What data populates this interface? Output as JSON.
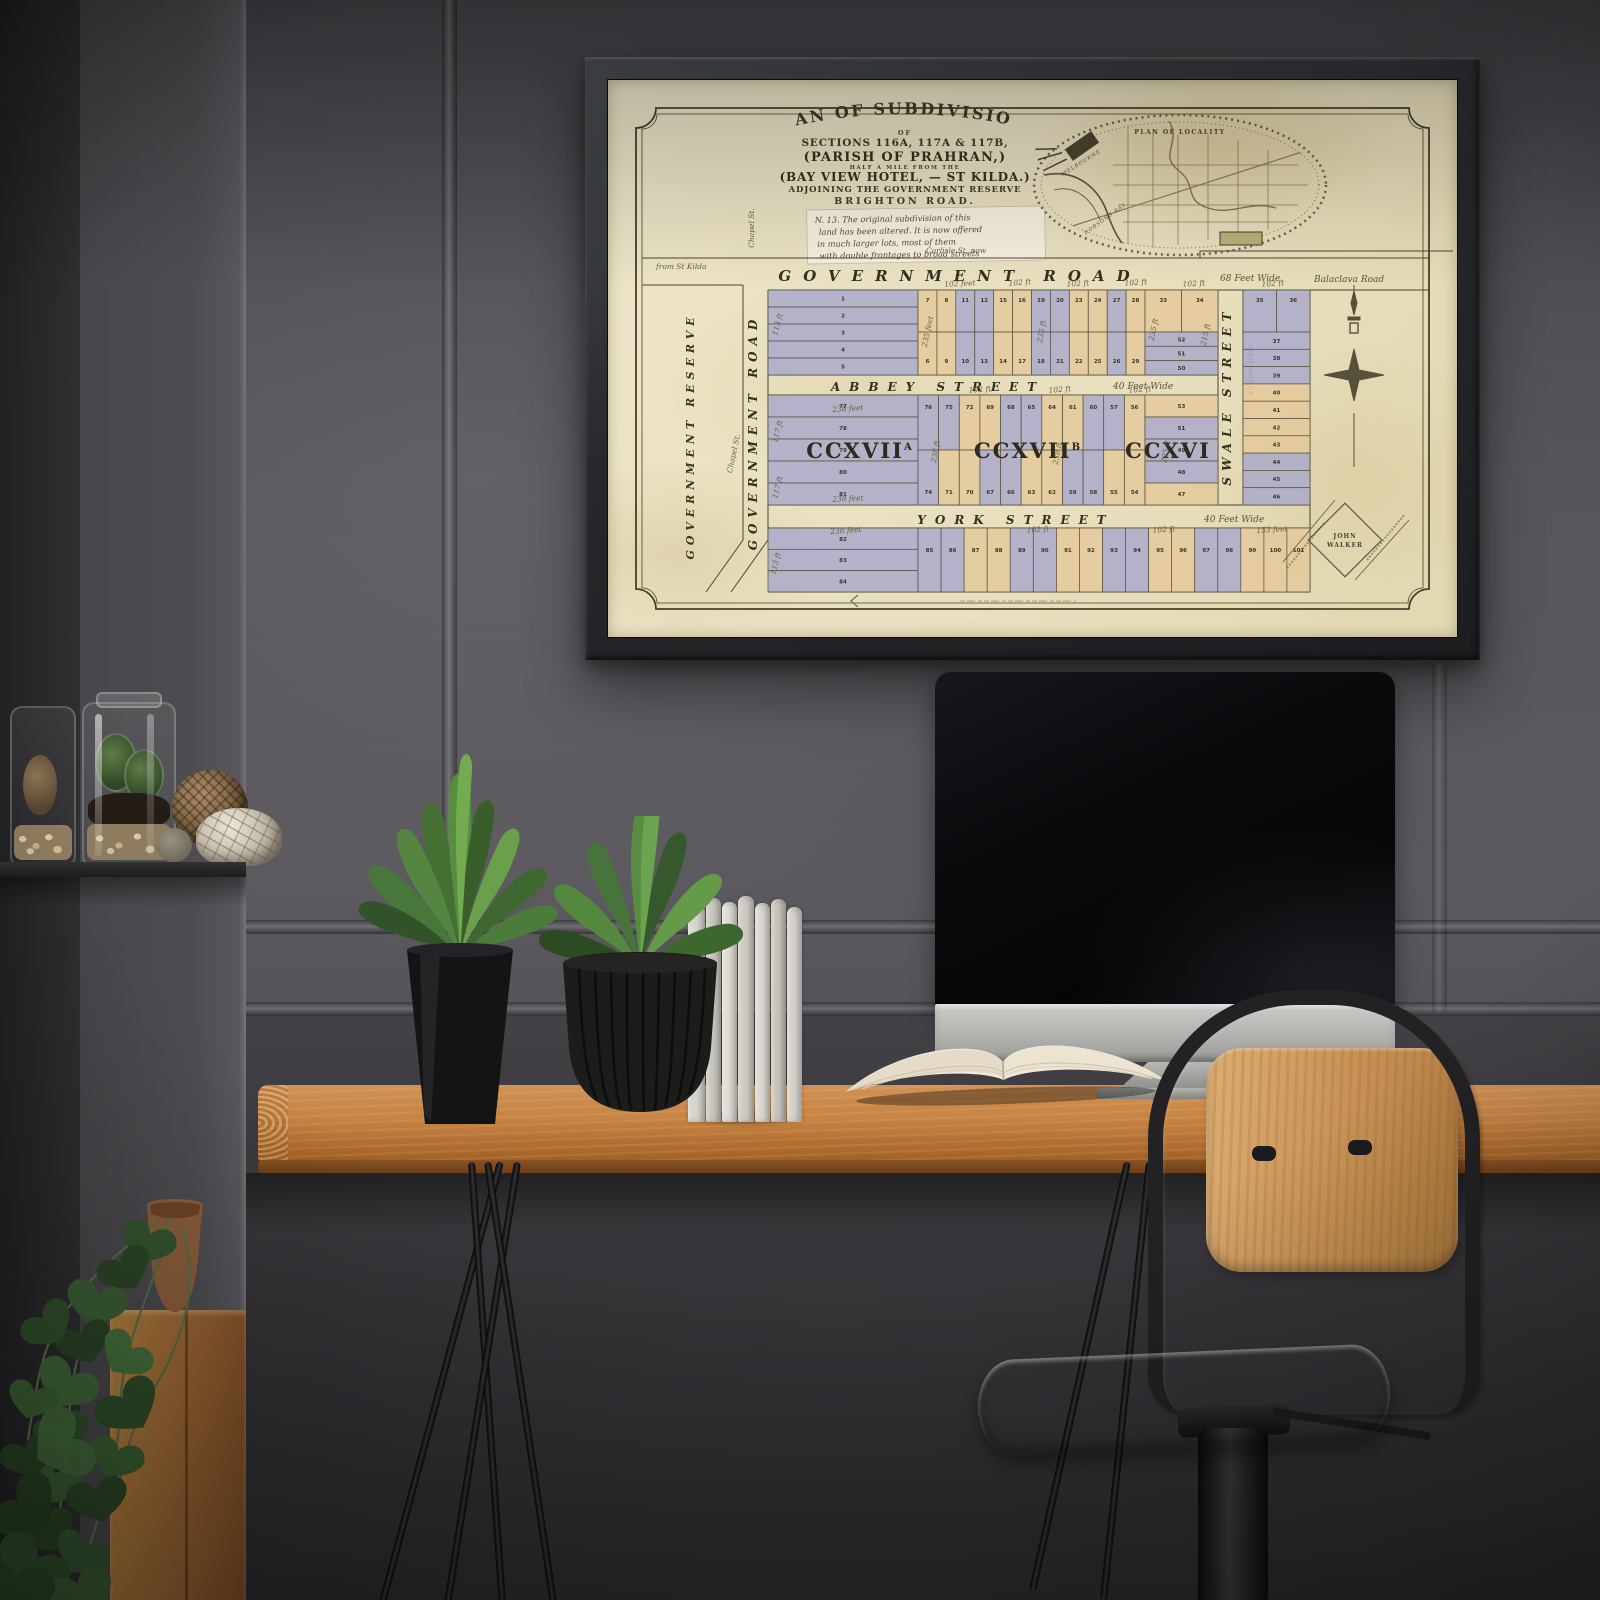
{
  "scene": {
    "palette": {
      "wall": "#57555a",
      "wall_left": "#47464a",
      "desk_wood": "#c08343",
      "frame": "#2e3033",
      "monitor_silver": "#b7b7b3",
      "chair_wood": "#c99356",
      "plant_green": "#568c3f"
    }
  },
  "map": {
    "palette": {
      "paper": "#eae3c2",
      "ink": "#3f3b28",
      "script": "#6b6040",
      "lot_blue": "#a8a8ca",
      "lot_tan": "#e4c89b",
      "lot_cream": "#e7e0bf"
    },
    "title": {
      "line1": "PLAN OF SUBDIVISIONS",
      "line2": "OF",
      "line3": "SECTIONS 116A, 117A & 117B,",
      "line4": "(PARISH OF PRAHRAN,)",
      "line5": "HALF A MILE FROM THE",
      "line6": "(BAY VIEW HOTEL, — ST KILDA.)",
      "line7": "ADJOINING THE GOVERNMENT RESERVE",
      "line8": "BRIGHTON ROAD."
    },
    "note_lines": [
      "N. 13. The original subdivision of this",
      "land has been altered.  It is now offered",
      "in much larger lots, most of them",
      "with double frontages to broad streets"
    ],
    "locality": {
      "title": "PLAN OF LOCALITY",
      "bay": "HOBSONS BAY",
      "city": "MELBOURNE"
    },
    "roads": {
      "government": "GOVERNMENT ROAD",
      "government_width": "68 Feet Wide",
      "balaclava": "Balaclava Road",
      "carlisle": "Carlisle St. now",
      "from_st_kilda": "from St Kilda",
      "chapel": "Chapel St.",
      "reserve": "GOVERNMENT RESERVE",
      "government_v": "GOVERNMENT ROAD",
      "abbey": "ABBEY STREET",
      "abbey_width": "40 Feet Wide",
      "york": "YORK STREET",
      "york_width": "40 Feet Wide",
      "swale": "SWALE STREET",
      "swale_width": "40 Feet Wide"
    },
    "sections": [
      {
        "name": "CCXVII",
        "sup": "A",
        "x": 252,
        "y": 378
      },
      {
        "name": "CCXVII",
        "sup": "B",
        "x": 420,
        "y": 378
      },
      {
        "name": "CCXVI",
        "sup": "",
        "x": 560,
        "y": 378
      }
    ],
    "stamp": {
      "line1": "JOHN",
      "line2": "WALKER"
    },
    "blocks": {
      "a_left": {
        "lots": [
          "1",
          "2",
          "3",
          "4",
          "5"
        ],
        "colors": [
          "b",
          "b",
          "b",
          "b",
          "b"
        ]
      },
      "a_top": {
        "lots": [
          "7",
          "8",
          "11",
          "12",
          "15",
          "16",
          "19",
          "20",
          "23",
          "24",
          "27",
          "28"
        ],
        "colors": [
          "t",
          "t",
          "b",
          "b",
          "t",
          "t",
          "b",
          "b",
          "t",
          "t",
          "b",
          "t"
        ]
      },
      "a_bottom": {
        "lots": [
          "6",
          "9",
          "10",
          "13",
          "14",
          "17",
          "18",
          "21",
          "22",
          "25",
          "26",
          "29"
        ],
        "colors": [
          "t",
          "t",
          "b",
          "b",
          "t",
          "t",
          "b",
          "b",
          "t",
          "t",
          "b",
          "t"
        ]
      },
      "a_corner_top": {
        "lots": [
          "33",
          "34"
        ],
        "colors": [
          "t",
          "t"
        ]
      },
      "a_corner_stack": {
        "lots": [
          "52",
          "51",
          "50"
        ],
        "colors": [
          "b",
          "b",
          "b"
        ]
      },
      "r_pair": {
        "lots": [
          "35",
          "36"
        ],
        "colors": [
          "b",
          "b"
        ]
      },
      "r_stack": {
        "lots": [
          "37",
          "38",
          "39",
          "40",
          "41",
          "42",
          "43",
          "44",
          "45",
          "46"
        ],
        "colors": [
          "b",
          "b",
          "b",
          "t",
          "t",
          "t",
          "t",
          "b",
          "b",
          "b"
        ]
      },
      "b_left": {
        "lots": [
          "77",
          "78",
          "79",
          "80",
          "81"
        ],
        "colors": [
          "b",
          "b",
          "b",
          "b",
          "b"
        ]
      },
      "b_top": {
        "lots": [
          "76",
          "75",
          "72",
          "69",
          "68",
          "65",
          "64",
          "61",
          "60",
          "57",
          "56"
        ],
        "colors": [
          "b",
          "b",
          "t",
          "t",
          "b",
          "b",
          "t",
          "t",
          "b",
          "b",
          "t"
        ]
      },
      "b_bottom": {
        "lots": [
          "74",
          "71",
          "70",
          "67",
          "66",
          "63",
          "62",
          "59",
          "58",
          "55",
          "54"
        ],
        "colors": [
          "b",
          "t",
          "t",
          "b",
          "b",
          "t",
          "t",
          "b",
          "b",
          "t",
          "t"
        ]
      },
      "b_corner": {
        "lots": [
          "53",
          "51",
          "49",
          "48",
          "47"
        ],
        "colors": [
          "t",
          "b",
          "b",
          "b",
          "t"
        ]
      },
      "c_left": {
        "lots": [
          "82",
          "83",
          "84"
        ],
        "colors": [
          "b",
          "b",
          "b"
        ]
      },
      "c_row": {
        "lots": [
          "85",
          "86",
          "87",
          "88",
          "89",
          "90",
          "91",
          "92",
          "93",
          "94",
          "95",
          "96",
          "97",
          "98",
          "99",
          "100",
          "101"
        ],
        "colors": [
          "b",
          "b",
          "t",
          "t",
          "b",
          "b",
          "t",
          "t",
          "b",
          "b",
          "t",
          "t",
          "b",
          "b",
          "t",
          "t",
          "t"
        ]
      }
    },
    "annotations": [
      {
        "t": "102 feet",
        "x": 352,
        "y": 206,
        "r": -3
      },
      {
        "t": "102 ft",
        "x": 412,
        "y": 205,
        "r": -4
      },
      {
        "t": "102 ft",
        "x": 470,
        "y": 206,
        "r": -3
      },
      {
        "t": "102 ft",
        "x": 528,
        "y": 205,
        "r": -4
      },
      {
        "t": "102 ft",
        "x": 586,
        "y": 206,
        "r": -3
      },
      {
        "t": "102 ft",
        "x": 665,
        "y": 206,
        "r": -4
      },
      {
        "t": "235 feet",
        "x": 322,
        "y": 252,
        "r": -78
      },
      {
        "t": "235 ft",
        "x": 436,
        "y": 252,
        "r": -80
      },
      {
        "t": "235 ft",
        "x": 548,
        "y": 250,
        "r": -78
      },
      {
        "t": "113 ft",
        "x": 172,
        "y": 245,
        "r": -75
      },
      {
        "t": "102 ft",
        "x": 372,
        "y": 312,
        "r": -3
      },
      {
        "t": "102 ft",
        "x": 452,
        "y": 312,
        "r": -4
      },
      {
        "t": "102 ft",
        "x": 532,
        "y": 312,
        "r": -3
      },
      {
        "t": "238 feet",
        "x": 240,
        "y": 331,
        "r": -4
      },
      {
        "t": "238 feet",
        "x": 240,
        "y": 421,
        "r": -3
      },
      {
        "t": "117 ft",
        "x": 172,
        "y": 352,
        "r": -75
      },
      {
        "t": "117 ft",
        "x": 172,
        "y": 408,
        "r": -75
      },
      {
        "t": "238 ft",
        "x": 330,
        "y": 372,
        "r": -80
      },
      {
        "t": "238 ft",
        "x": 452,
        "y": 374,
        "r": -78
      },
      {
        "t": "235 ft",
        "x": 560,
        "y": 372,
        "r": -80
      },
      {
        "t": "215 ft",
        "x": 600,
        "y": 255,
        "r": -78
      },
      {
        "t": "238 feet",
        "x": 238,
        "y": 453,
        "r": -4
      },
      {
        "t": "102 ft",
        "x": 430,
        "y": 452,
        "r": -3
      },
      {
        "t": "102 ft",
        "x": 556,
        "y": 452,
        "r": -4
      },
      {
        "t": "153 feet",
        "x": 664,
        "y": 452,
        "r": -3
      },
      {
        "t": "113 ft",
        "x": 170,
        "y": 484,
        "r": -75
      }
    ]
  }
}
